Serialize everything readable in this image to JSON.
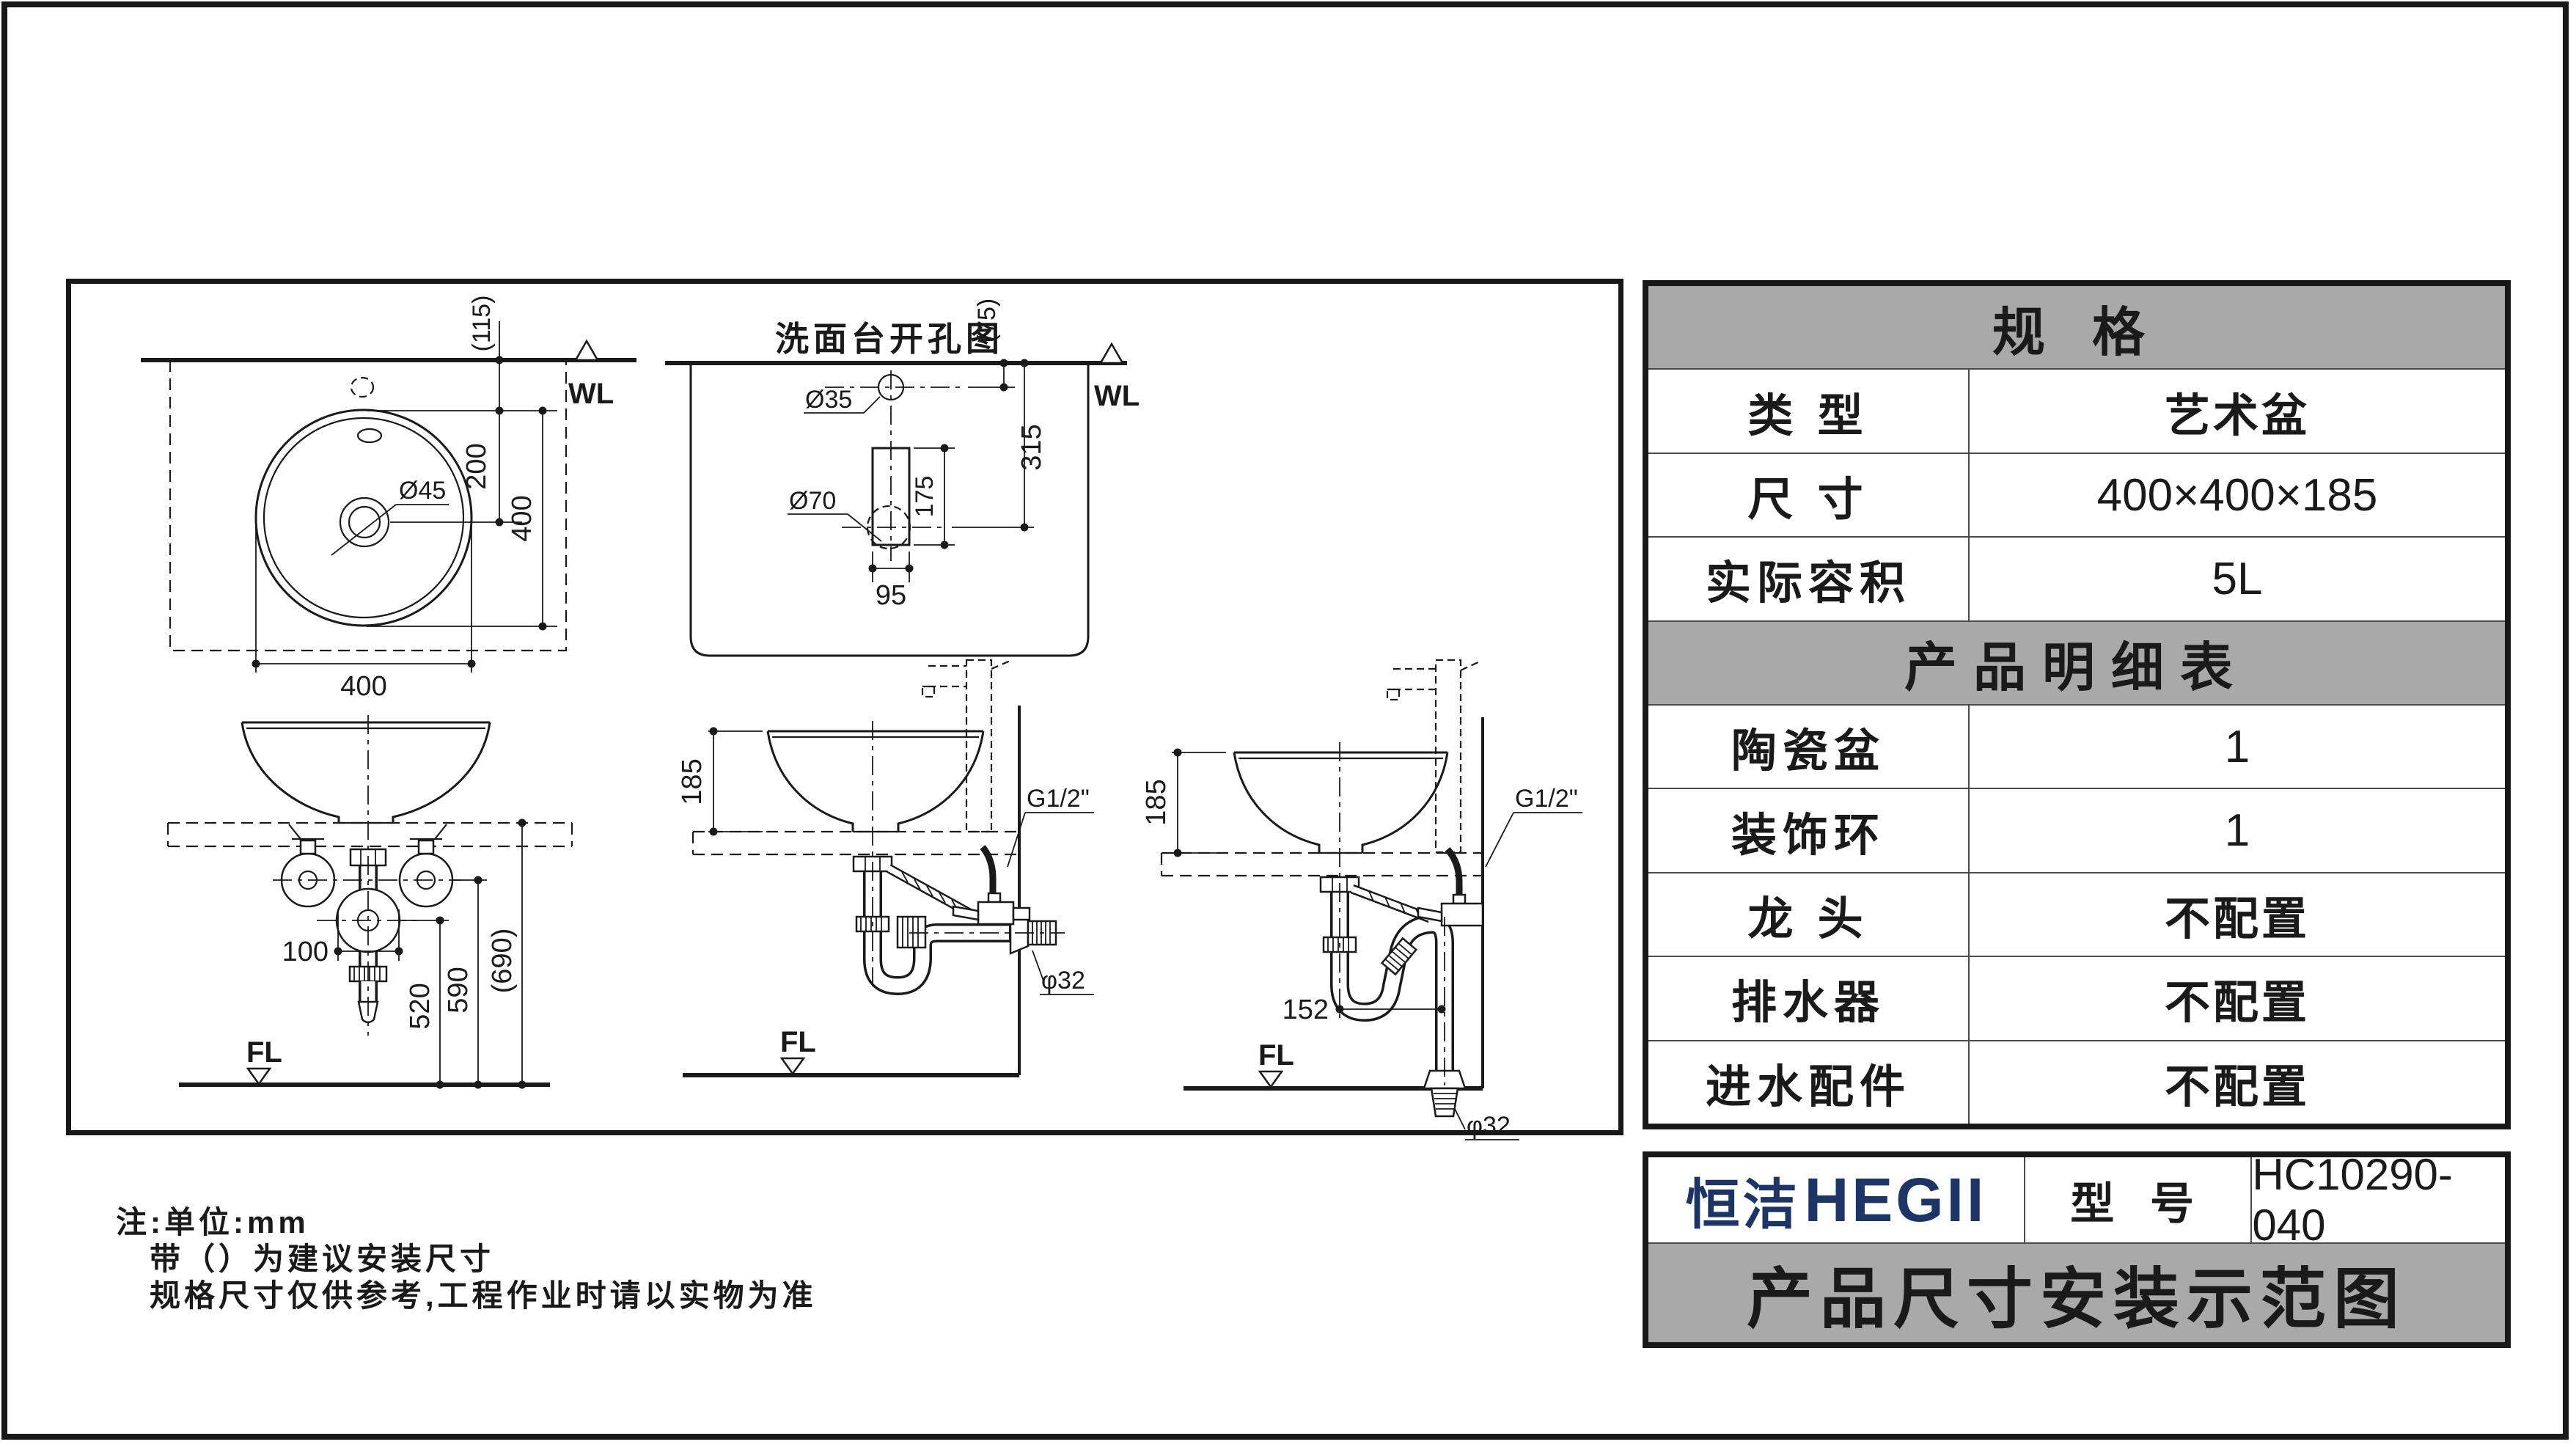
{
  "colors": {
    "navy": "#1c3566",
    "header_gray": "#a9a9a9",
    "line": "#1a1a1a"
  },
  "spec_table": {
    "header": "规 格",
    "rows": [
      {
        "label": "类 型",
        "value": "艺术盆"
      },
      {
        "label": "尺 寸",
        "value": "400×400×185"
      },
      {
        "label": "实际容积",
        "value": "5L"
      }
    ],
    "detail_header": "产品明细表",
    "detail_rows": [
      {
        "label": "陶瓷盆",
        "value": "1"
      },
      {
        "label": "装饰环",
        "value": "1"
      },
      {
        "label": "龙 头",
        "value": "不配置"
      },
      {
        "label": "排水器",
        "value": "不配置"
      },
      {
        "label": "进水配件",
        "value": "不配置"
      }
    ]
  },
  "title_block": {
    "brand_cn": "恒洁",
    "brand_en": "HEGII",
    "model_label": "型 号",
    "model_value": "HC10290-040",
    "sheet_title": "产品尺寸安装示范图"
  },
  "notes": {
    "line1": "注:单位:mm",
    "line2": "带（）为建议安装尺寸",
    "line3": "规格尺寸仅供参考,工程作业时请以实物为准"
  },
  "drawings": {
    "top_view": {
      "wl": "WL",
      "dim_offset": "(115)",
      "dim_center": "200",
      "dim_height": "400",
      "dim_width": "400",
      "drain": "Ø45"
    },
    "hole_view": {
      "title": "洗面台开孔图",
      "wl": "WL",
      "dim_offset": "(75)",
      "faucet_hole": "Ø35",
      "drain_hole": "Ø70",
      "dim_slot_h": "175",
      "dim_slot_w": "95",
      "dim_drain": "315"
    },
    "front_view": {
      "fl": "FL",
      "dim_valves": "100",
      "dim_520": "520",
      "dim_590": "590",
      "dim_690": "(690)"
    },
    "side_view_wall": {
      "fl": "FL",
      "dim_height": "185",
      "inlet": "G1/2\"",
      "outlet": "φ32"
    },
    "side_view_floor": {
      "fl": "FL",
      "dim_height": "185",
      "dim_offset": "152",
      "inlet": "G1/2\"",
      "outlet": "φ32"
    }
  }
}
